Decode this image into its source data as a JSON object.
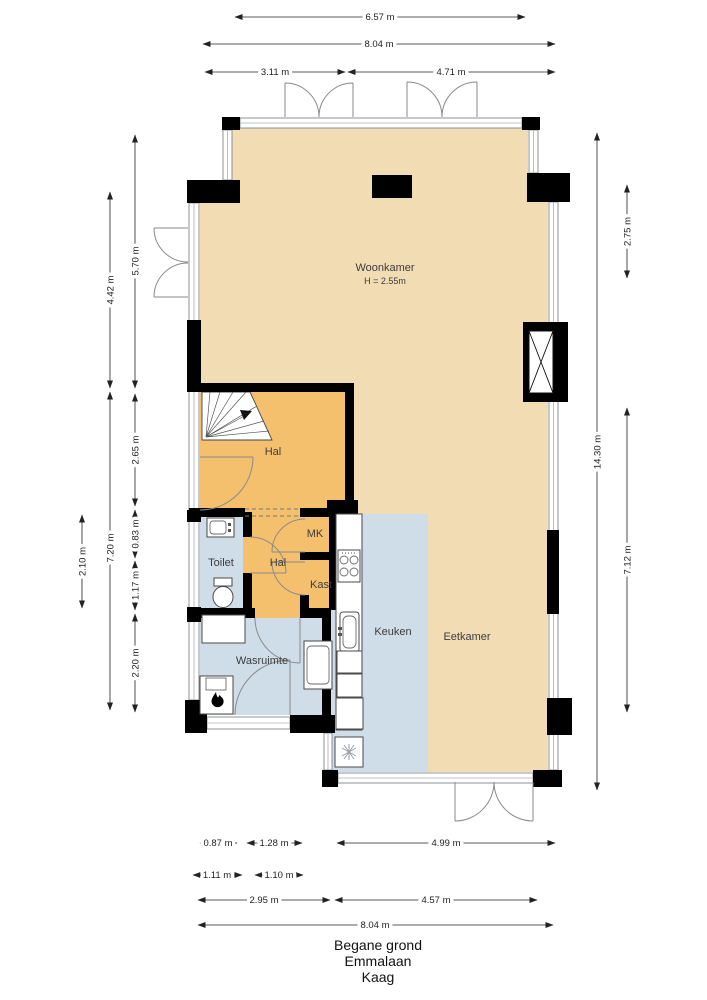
{
  "title_block": {
    "floor": "Begane grond",
    "street": "Emmalaan",
    "city": "Kaag"
  },
  "rooms": {
    "woonkamer": {
      "label": "Woonkamer",
      "height_note": "H = 2.55m"
    },
    "hal_upper": {
      "label": "Hal"
    },
    "hal_lower": {
      "label": "Hal"
    },
    "toilet": {
      "label": "Toilet"
    },
    "mk": {
      "label": "MK"
    },
    "kast": {
      "label": "Kast"
    },
    "keuken": {
      "label": "Keuken"
    },
    "eetkamer": {
      "label": "Eetkamer"
    },
    "wasruimte": {
      "label": "Wasruimte"
    }
  },
  "dimensions": {
    "top": [
      {
        "label": "6.57 m"
      },
      {
        "label": "8.04 m"
      },
      {
        "label": "3.11 m"
      },
      {
        "label": "4.71 m"
      }
    ],
    "left": [
      {
        "label": "5.70 m"
      },
      {
        "label": "4.42 m"
      },
      {
        "label": "2.65 m"
      },
      {
        "label": "0.83 m"
      },
      {
        "label": "1.17 m"
      },
      {
        "label": "2.20 m"
      },
      {
        "label": "2.10 m"
      },
      {
        "label": "7.20 m"
      }
    ],
    "right": [
      {
        "label": "2.75 m"
      },
      {
        "label": "14.30 m"
      },
      {
        "label": "7.12 m"
      }
    ],
    "bottom": [
      {
        "label": "0.87 m"
      },
      {
        "label": "1.28 m"
      },
      {
        "label": "4.99 m"
      },
      {
        "label": "1.11 m"
      },
      {
        "label": "1.10 m"
      },
      {
        "label": "2.95 m"
      },
      {
        "label": "4.57 m"
      },
      {
        "label": "8.04 m"
      }
    ]
  },
  "icons": {
    "boiler": "flame-icon",
    "kitchen_floor_unit": "asterisk-icon",
    "stairs_direction": "up-arrow-icon"
  },
  "colors": {
    "room_living": "#f2dcb4",
    "room_hall": "#f5c06e",
    "room_service": "#cfdde9",
    "wall": "#000000",
    "window_frame": "#8c9196",
    "dimension": "#222222"
  }
}
